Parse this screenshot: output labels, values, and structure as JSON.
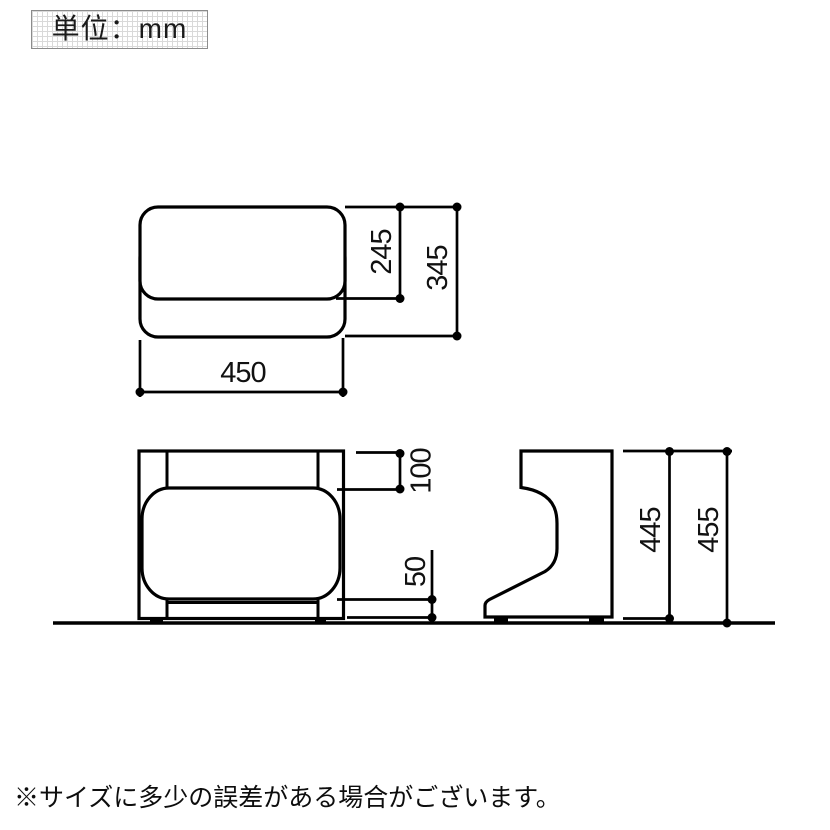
{
  "unit_box": {
    "label": "単位：mm"
  },
  "footer": {
    "note": "※サイズに多少の誤差がある場合がございます。"
  },
  "drawing": {
    "line_color": "#000000",
    "background": "#ffffff",
    "dims": {
      "top_width": "450",
      "top_seat_depth": "245",
      "top_total_depth": "345",
      "front_back_height": "100",
      "front_base_height": "50",
      "side_frame_height": "445",
      "side_total_height": "455"
    }
  }
}
